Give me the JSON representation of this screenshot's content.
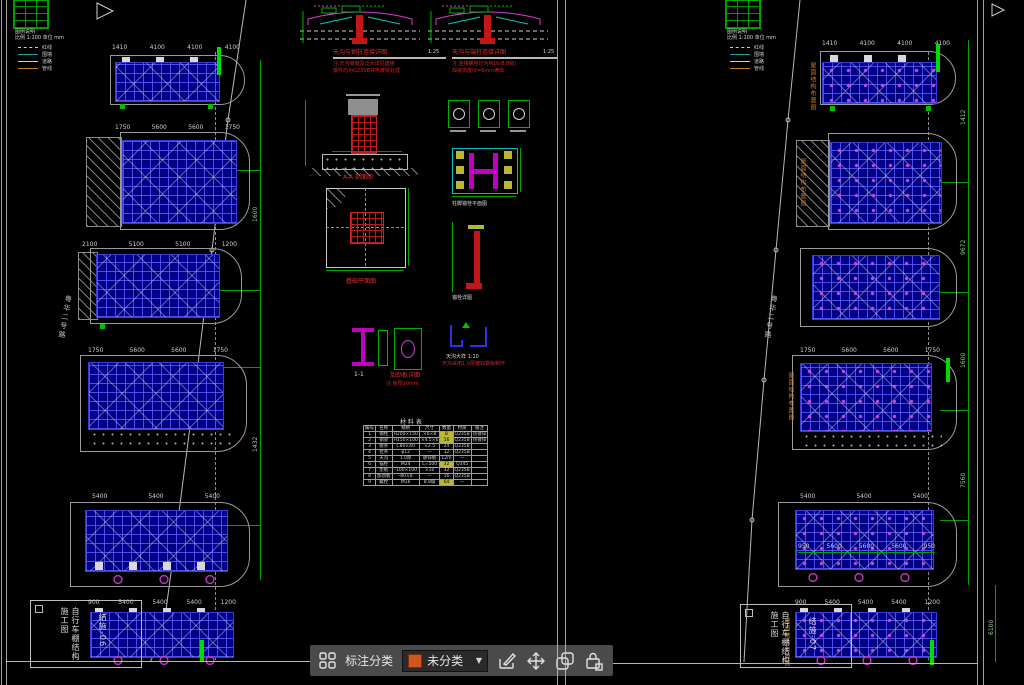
{
  "toolbar": {
    "category_label": "标注分类",
    "dropdown_value": "未分类",
    "swatch_color": "#d4541e"
  },
  "legend": {
    "note1": "图例说明",
    "note2": "比例 1:100 单位 mm",
    "items": [
      {
        "label": "红线",
        "color": "#cccccc",
        "style": "dashed"
      },
      {
        "label": "围墙",
        "color": "#22a0a0",
        "style": "solid"
      },
      {
        "label": "道路",
        "color": "#cccccc",
        "style": "solid"
      },
      {
        "label": "管线",
        "color": "#c87c1e",
        "style": "solid"
      }
    ]
  },
  "dims": {
    "a": [
      "1410",
      "4100",
      "4100",
      "4100"
    ],
    "b": [
      "1750",
      "5600",
      "5600",
      "1750"
    ],
    "c": [
      "2100",
      "5100",
      "5100",
      "1200"
    ],
    "e": [
      "5400",
      "5400",
      "5400"
    ],
    "f": [
      "900",
      "5400",
      "5400",
      "5400",
      "1200"
    ],
    "r5b": [
      "950",
      "5600",
      "5600",
      "5600",
      "950"
    ],
    "v_left": [
      "1600",
      "1432"
    ],
    "v_right": [
      "1412",
      "9672",
      "1600",
      "7560"
    ],
    "v_br": "6100"
  },
  "labels": {
    "road": "粤华二号路",
    "roof_plan": "屋面结构布置图",
    "detail1_title": "天沟与钢柱连接详图",
    "detail1_scale": "1:25",
    "detail1_note1": "注:天沟坡度及泛水详见建施",
    "detail1_note2": "钢件均为Q235B并热镀锌处理",
    "detail2_title": "天沟与端柱连接详图",
    "detail2_scale": "1:25",
    "detail2_note1": "注:连接螺栓均为M16(8.8级)",
    "detail2_note2": "焊缝高度hf=6mm满焊",
    "section_label": "A-A 剖面图",
    "plan_label": "基础平面图",
    "baseplate_label": "柱脚锚栓平面图",
    "jbolt_label": "锚栓详图",
    "ibeam_label": "1-1",
    "plate_label": "加劲板详图",
    "plate_note": "注:板厚10mm",
    "gutter_label": "天沟大样 1:10",
    "gutter_note": "天沟采用1.0厚镀锌钢板制作",
    "titleblock_line1": "自行车棚结构施工图",
    "titleblock_line2": "结施-06",
    "titleblock_line1_r": "自行车棚结构施工图",
    "titleblock_line2_r": "结施-07"
  },
  "table": {
    "title": "材 料 表",
    "headers": [
      "编号",
      "名称",
      "规格",
      "尺寸",
      "数量",
      "材质",
      "备注"
    ],
    "rows": [
      {
        "cells": [
          "1",
          "钢柱",
          "H200×150",
          "×6×8",
          "8",
          "Q235B",
          "热镀锌"
        ],
        "hl": 4
      },
      {
        "cells": [
          "2",
          "钢梁",
          "H150×100",
          "×4.5×6",
          "16",
          "Q235B",
          "热镀锌"
        ],
        "hl": 4
      },
      {
        "cells": [
          "3",
          "檩条",
          "C80×40",
          "×2.5",
          "24",
          "Q235B",
          ""
        ],
        "hl": -1
      },
      {
        "cells": [
          "4",
          "拉条",
          "φ12",
          "—",
          "32",
          "Q235B",
          ""
        ],
        "hl": -1
      },
      {
        "cells": [
          "5",
          "天沟",
          "1.0厚",
          "镀锌板",
          "12m",
          "—",
          ""
        ],
        "hl": -1
      },
      {
        "cells": [
          "6",
          "锚栓",
          "M24",
          "L=500",
          "32",
          "Q345",
          ""
        ],
        "hl": 4
      },
      {
        "cells": [
          "7",
          "垫板",
          "-100×100",
          "×10",
          "32",
          "Q235B",
          ""
        ],
        "hl": -1
      },
      {
        "cells": [
          "8",
          "加劲板",
          "-80×8",
          "—",
          "16",
          "Q235B",
          ""
        ],
        "hl": -1
      },
      {
        "cells": [
          "9",
          "螺栓",
          "M16",
          "8.8级",
          "64",
          "—",
          ""
        ],
        "hl": 4
      }
    ]
  }
}
